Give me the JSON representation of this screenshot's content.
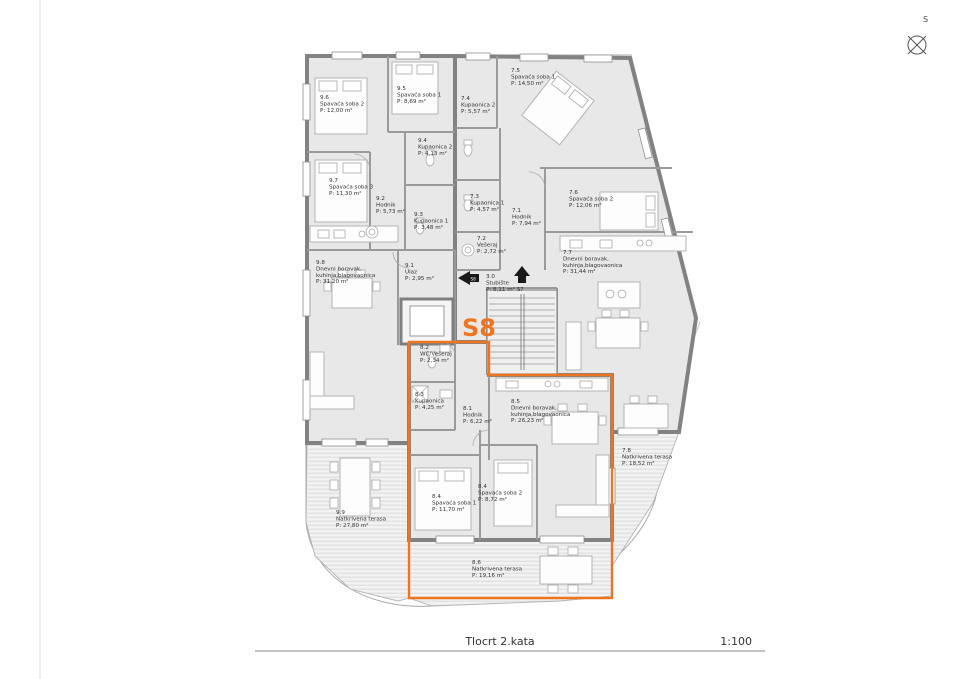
{
  "footer": {
    "title": "Tlocrt 2.kata",
    "scale": "1:100"
  },
  "compass": {
    "label": "S"
  },
  "unit_highlight": {
    "label": "S8",
    "color": "#ED7420"
  },
  "arrows": [
    {
      "label": "S8",
      "direction": "left"
    },
    {
      "label": "S7",
      "direction": "up"
    }
  ],
  "rooms": [
    {
      "key": "r96",
      "num": "9.6",
      "name": [
        "Spavaća soba 2"
      ],
      "area": "P: 12,00 m²"
    },
    {
      "key": "r95",
      "num": "9.5",
      "name": [
        "Spavaća soba 1"
      ],
      "area": "P: 8,69 m²"
    },
    {
      "key": "r74",
      "num": "7.4",
      "name": [
        "Kupaonica 2"
      ],
      "area": "P: 5,57 m²"
    },
    {
      "key": "r75",
      "num": "7.5",
      "name": [
        "Spavaća soba 1"
      ],
      "area": "P: 14,50 m²"
    },
    {
      "key": "r94",
      "num": "9.4",
      "name": [
        "Kupaonica 2"
      ],
      "area": "P: 4,13 m²"
    },
    {
      "key": "r97",
      "num": "9.7",
      "name": [
        "Spavaća soba 3"
      ],
      "area": "P: 11,30 m²"
    },
    {
      "key": "r92",
      "num": "9.2",
      "name": [
        "Hodnik"
      ],
      "area": "P: 5,73 m²"
    },
    {
      "key": "r93",
      "num": "9.3",
      "name": [
        "Kupaonica 1"
      ],
      "area": "P: 3,48 m²"
    },
    {
      "key": "r73",
      "num": "7.3",
      "name": [
        "Kupaonica 1"
      ],
      "area": "P: 4,57 m²"
    },
    {
      "key": "r71",
      "num": "7.1",
      "name": [
        "Hodnik"
      ],
      "area": "P: 7,94 m²"
    },
    {
      "key": "r76",
      "num": "7.6",
      "name": [
        "Spavaća soba 2"
      ],
      "area": "P: 12,06 m²"
    },
    {
      "key": "r72",
      "num": "7.2",
      "name": [
        "Vešeraj"
      ],
      "area": "P: 2,72 m²"
    },
    {
      "key": "r77",
      "num": "7.7",
      "name": [
        "Dnevni boravak,",
        "kuhinja,blagovaonica"
      ],
      "area": "P: 31,44 m²"
    },
    {
      "key": "r98",
      "num": "9.8",
      "name": [
        "Dnevni boravak,",
        "kuhinja,blagovaonica"
      ],
      "area": "P: 31,20 m²"
    },
    {
      "key": "r91",
      "num": "9.1",
      "name": [
        "Ulaz"
      ],
      "area": "P: 2,95 m²"
    },
    {
      "key": "r30",
      "num": "3.0",
      "name": [
        "Stubište"
      ],
      "area": "P: 8,11 m²"
    },
    {
      "key": "r82",
      "num": "8.2",
      "name": [
        "WC/Vešeraj"
      ],
      "area": "P: 2,34 m²"
    },
    {
      "key": "r83",
      "num": "8.3",
      "name": [
        "Kupaonica"
      ],
      "area": "P: 4,25 m²"
    },
    {
      "key": "r81",
      "num": "8.1",
      "name": [
        "Hodnik"
      ],
      "area": "P: 6,22 m²"
    },
    {
      "key": "r85",
      "num": "8.5",
      "name": [
        "Dnevni boravak,",
        "kuhinja,blagovaonica"
      ],
      "area": "P: 26,23 m²"
    },
    {
      "key": "r84a",
      "num": "8.4",
      "name": [
        "Spavaća soba 1"
      ],
      "area": "P: 11,70 m²"
    },
    {
      "key": "r84b",
      "num": "8.4",
      "name": [
        "Spavaća soba 2"
      ],
      "area": "P: 8,72 m²"
    },
    {
      "key": "r99",
      "num": "9.9",
      "name": [
        "Natkrivena terasa"
      ],
      "area": "P: 27,80 m²"
    },
    {
      "key": "r78",
      "num": "7.8",
      "name": [
        "Natkrivena terasa"
      ],
      "area": "P: 18,52 m²"
    },
    {
      "key": "r86",
      "num": "8.6",
      "name": [
        "Natkrivena terasa"
      ],
      "area": "P: 19,16 m²"
    }
  ]
}
